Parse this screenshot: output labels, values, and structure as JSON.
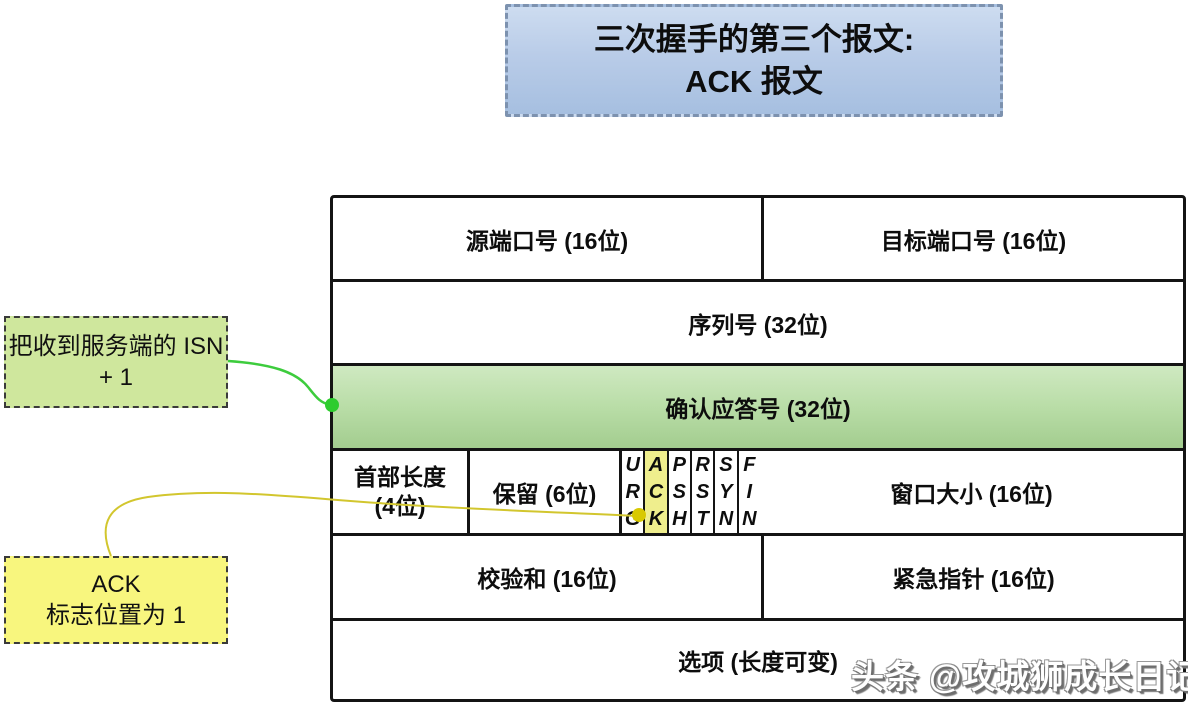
{
  "title": {
    "line1": "三次握手的第三个报文:",
    "line2": "ACK 报文"
  },
  "annotations": {
    "isn_note": {
      "line1": "把收到服务端的 ISN",
      "line2": "+ 1"
    },
    "ack_note": {
      "line1": "ACK",
      "line2": "标志位置为 1"
    }
  },
  "header_table": {
    "row1": {
      "left": "源端口号 (16位)",
      "right": "目标端口号 (16位)"
    },
    "row2": {
      "label": "序列号 (32位)"
    },
    "row3": {
      "label": "确认应答号 (32位)"
    },
    "row4": {
      "header_len_line1": "首部长度",
      "header_len_line2": "(4位)",
      "reserved": "保留 (6位)",
      "window": "窗口大小 (16位)"
    },
    "flags": [
      {
        "name": "URG",
        "l1": "U",
        "l2": "R",
        "l3": "G",
        "highlight": false
      },
      {
        "name": "ACK",
        "l1": "A",
        "l2": "C",
        "l3": "K",
        "highlight": true
      },
      {
        "name": "PSH",
        "l1": "P",
        "l2": "S",
        "l3": "H",
        "highlight": false
      },
      {
        "name": "RST",
        "l1": "R",
        "l2": "S",
        "l3": "T",
        "highlight": false
      },
      {
        "name": "SYN",
        "l1": "S",
        "l2": "Y",
        "l3": "N",
        "highlight": false
      },
      {
        "name": "FIN",
        "l1": "F",
        "l2": "I",
        "l3": "N",
        "highlight": false
      }
    ],
    "row5": {
      "left": "校验和 (16位)",
      "right": "紧急指针 (16位)"
    },
    "row6": {
      "label": "选项 (长度可变)"
    }
  },
  "watermark": "头条 @攻城狮成长日记",
  "colors": {
    "title_gradient_top": "#cddcf0",
    "title_gradient_bottom": "#a6bfe0",
    "title_border": "#7d92af",
    "ack_row_gradient_top": "#cfe9c1",
    "ack_row_gradient_bottom": "#a3cd8f",
    "ack_flag_highlight": "#efee8d",
    "isn_note_bg": "#cfe79d",
    "ack_note_bg": "#f8f67e",
    "isn_connector": "#3dcc3d",
    "ack_connector": "#d2c62e",
    "table_border": "#141414"
  }
}
